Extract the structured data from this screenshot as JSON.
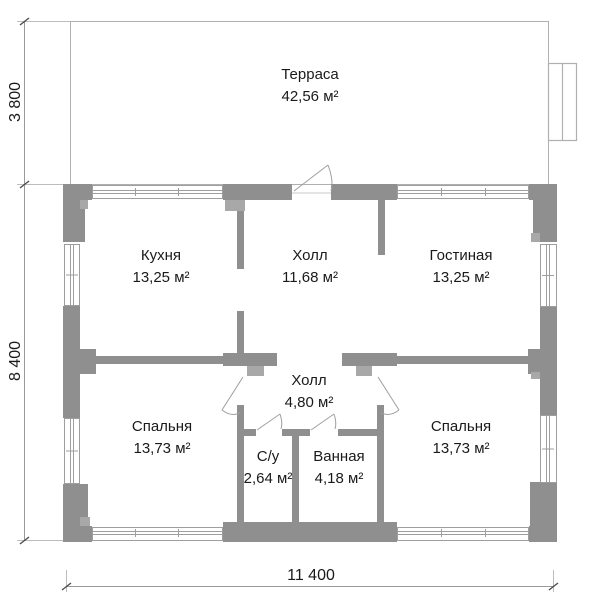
{
  "rooms": {
    "terrace": {
      "name": "Терраса",
      "area": "42,56 м²"
    },
    "kitchen": {
      "name": "Кухня",
      "area": "13,25 м²"
    },
    "hall_upper": {
      "name": "Холл",
      "area": "11,68 м²"
    },
    "living": {
      "name": "Гостиная",
      "area": "13,25 м²"
    },
    "bedroom_left": {
      "name": "Спальня",
      "area": "13,73 м²"
    },
    "hall_lower": {
      "name": "Холл",
      "area": "4,80 м²"
    },
    "wc": {
      "name": "С/у",
      "area": "2,64 м²"
    },
    "bath": {
      "name": "Ванная",
      "area": "4,18 м²"
    },
    "bedroom_right": {
      "name": "Спальня",
      "area": "13,73 м²"
    }
  },
  "dimensions": {
    "terrace_depth": "3 800",
    "house_depth": "8 400",
    "house_width": "11 400"
  },
  "colors": {
    "wall": "#8f8f8f",
    "jamb": "#a8a8a8",
    "terrace_outline": "#b0b0b0",
    "window_frame": "#9e9e9e",
    "text": "#1a1a1a"
  }
}
